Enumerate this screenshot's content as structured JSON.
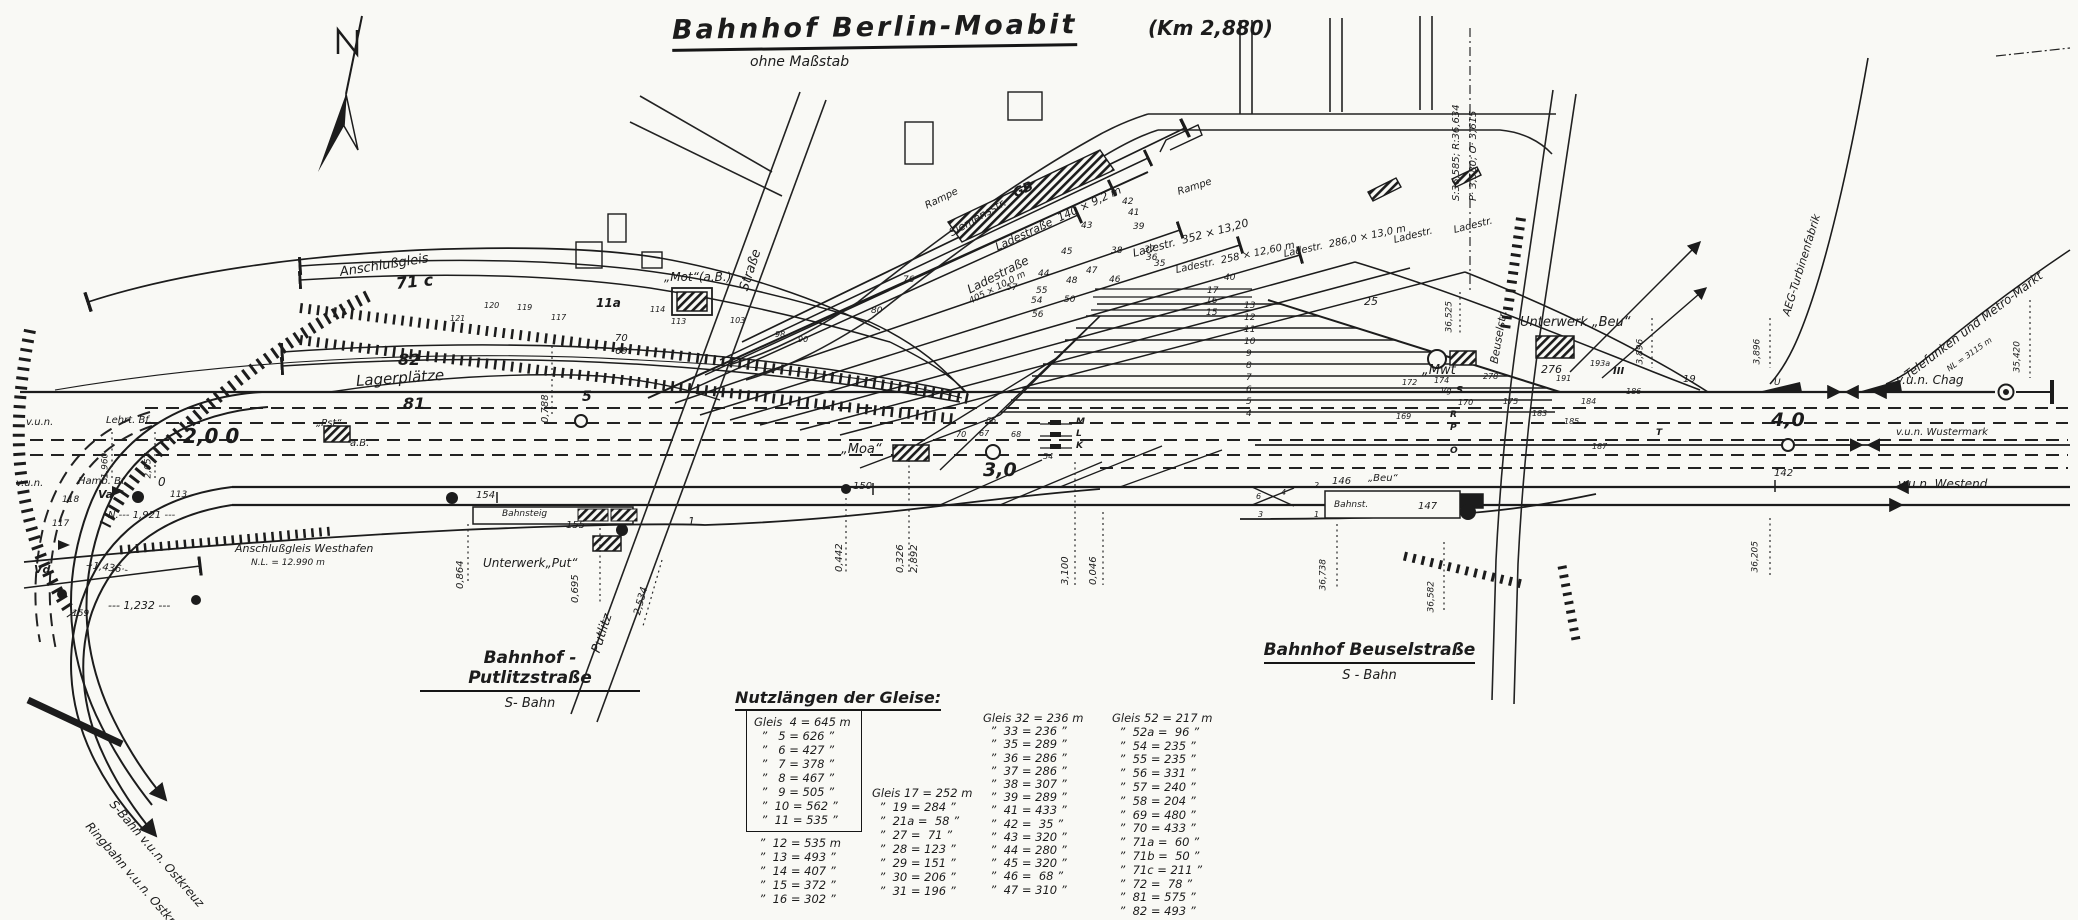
{
  "title": {
    "main": "Bahnhof Berlin-Moabit",
    "km": "(Km 2,880)",
    "subtitle": "ohne Maßstab"
  },
  "stations": [
    {
      "name": "Bahnhof - Putlitzstraße",
      "type": "S- Bahn"
    },
    {
      "name": "Bahnhof Beuselstraße",
      "type": "S - Bahn"
    }
  ],
  "track_lengths": {
    "title": "Nutzlängen der Gleise:",
    "col1_boxed": [
      "Gleis  4 = 645 m",
      "  ”   5 = 626 ”",
      "  ”   6 = 427 ”",
      "  ”   7 = 378 ”",
      "  ”   8 = 467 ”",
      "  ”   9 = 505 ”",
      "  ”  10 = 562 ”",
      "  ”  11 = 535 ”"
    ],
    "col1_rest": [
      "  ”  12 = 535 m",
      "  ”  13 = 493 ”",
      "  ”  14 = 407 ”",
      "  ”  15 = 372 ”",
      "  ”  16 = 302 ”"
    ],
    "col2": [
      "Gleis 17 = 252 m",
      "  ”  19 = 284 ”",
      "  ”  21a =  58 ”",
      "  ”  27 =  71 ”",
      "  ”  28 = 123 ”",
      "  ”  29 = 151 ”",
      "  ”  30 = 206 ”",
      "  ”  31 = 196 ”"
    ],
    "col3": [
      "Gleis 32 = 236 m",
      "  ”  33 = 236 ”",
      "  ”  35 = 289 ”",
      "  ”  36 = 286 ”",
      "  ”  37 = 286 ”",
      "  ”  38 = 307 ”",
      "  ”  39 = 289 ”",
      "  ”  41 = 433 ”",
      "  ”  42 =  35 ”",
      "  ”  43 = 320 ”",
      "  ”  44 = 280 ”",
      "  ”  45 = 320 ”",
      "  ”  46 =  68 ”",
      "  ”  47 = 310 ”"
    ],
    "col4": [
      "Gleis 52 = 217 m",
      "  ”  52a =  96 ”",
      "  ”  54 = 235 ”",
      "  ”  55 = 235 ”",
      "  ”  56 = 331 ”",
      "  ”  57 = 240 ”",
      "  ”  58 = 204 ”",
      "  ”  69 = 480 ”",
      "  ”  70 = 433 ”",
      "  ”  71a =  60 ”",
      "  ”  71b =  50 ”",
      "  ”  71c = 211 ”",
      "  ”  72 =  78 ”",
      "  ”  81 = 575 ”",
      "  ”  82 = 493 ”"
    ]
  },
  "annotations": [
    {
      "t": "Anschlußgleis",
      "x": 340,
      "y": 266,
      "r": -9,
      "s": 13,
      "n": "label-anschlussgleis"
    },
    {
      "t": "71 c",
      "x": 396,
      "y": 276,
      "r": -6,
      "s": 16,
      "c": "b"
    },
    {
      "t": "11a",
      "x": 596,
      "y": 297,
      "s": 12,
      "c": "b"
    },
    {
      "t": "70",
      "x": 615,
      "y": 334
    },
    {
      "t": "69",
      "x": 615,
      "y": 347
    },
    {
      "t": "82",
      "x": 398,
      "y": 352,
      "s": 16,
      "c": "b"
    },
    {
      "t": "Lagerplätze",
      "x": 356,
      "y": 374,
      "r": -4,
      "s": 15,
      "n": "label-lagerplaetze"
    },
    {
      "t": "81",
      "x": 403,
      "y": 396,
      "s": 16,
      "c": "b"
    },
    {
      "t": "0,788",
      "x": 546,
      "y": 418,
      "r": -90
    },
    {
      "t": "5",
      "x": 582,
      "y": 390,
      "s": 14,
      "c": "b"
    },
    {
      "t": "2,0 0",
      "x": 183,
      "y": 426,
      "s": 20,
      "c": "b",
      "n": "km-post-2"
    },
    {
      "t": "v.u.n.",
      "x": 26,
      "y": 418
    },
    {
      "t": "Lehrt. Bf.",
      "x": 106,
      "y": 416,
      "n": "label-lehrter-bf"
    },
    {
      "t": "1,960",
      "x": 106,
      "y": 474,
      "r": -90,
      "s": 9
    },
    {
      "t": "2,057",
      "x": 149,
      "y": 474,
      "r": -90,
      "s": 9
    },
    {
      "t": "v.u.n.",
      "x": 16,
      "y": 479
    },
    {
      "t": "Hamb. Bf.",
      "x": 78,
      "y": 477,
      "n": "label-hamburger-bf"
    },
    {
      "t": "0",
      "x": 158,
      "y": 476,
      "s": 12
    },
    {
      "t": "Va",
      "x": 98,
      "y": 489,
      "s": 11,
      "c": "b"
    },
    {
      "t": "118",
      "x": 62,
      "y": 496,
      "s": 9
    },
    {
      "t": "113",
      "x": 170,
      "y": 491,
      "s": 9
    },
    {
      "t": "N.--- 1,921 ---",
      "x": 108,
      "y": 511
    },
    {
      "t": "117",
      "x": 52,
      "y": 520,
      "s": 9
    },
    {
      "t": "Vd",
      "x": 34,
      "y": 564,
      "s": 11,
      "c": "b"
    },
    {
      "t": "-·1,436·-",
      "x": 86,
      "y": 561,
      "r": 7
    },
    {
      "t": "159",
      "x": 72,
      "y": 610,
      "s": 9
    },
    {
      "t": "--- 1,232 ---",
      "x": 108,
      "y": 600,
      "s": 11
    },
    {
      "t": "Anschlußgleis Westhafen",
      "x": 235,
      "y": 543,
      "s": 11,
      "n": "label-anschlussgleis-westhafen"
    },
    {
      "t": "N.L. = 12.990 m",
      "x": 251,
      "y": 559,
      "s": 9
    },
    {
      "t": "S-Bahn v.u.n. Ostkreuz",
      "x": 112,
      "y": 796,
      "r": 49,
      "s": 12,
      "n": "label-sbahn-ostkreuz"
    },
    {
      "t": "Ringbahn v.u.n. Ostkreuz",
      "x": 88,
      "y": 818,
      "r": 49,
      "s": 12,
      "n": "label-ringbahn-ostkreuz"
    },
    {
      "t": "„Pst“",
      "x": 316,
      "y": 419,
      "n": "label-stellwerk-pst"
    },
    {
      "t": "a.B.",
      "x": 350,
      "y": 439
    },
    {
      "t": "„Mot“(a.B.)",
      "x": 664,
      "y": 271,
      "s": 12,
      "n": "label-stellwerk-mot"
    },
    {
      "t": "Straße",
      "x": 744,
      "y": 284,
      "r": -72,
      "s": 13,
      "n": "label-strasse"
    },
    {
      "t": "Siemensstr.",
      "x": 950,
      "y": 228,
      "r": -30,
      "s": 11,
      "n": "label-siemensstrasse"
    },
    {
      "t": "Rampe",
      "x": 926,
      "y": 202,
      "r": -26
    },
    {
      "t": "Rampe",
      "x": 1178,
      "y": 188,
      "r": -18
    },
    {
      "t": "GB",
      "x": 1014,
      "y": 188,
      "r": -25,
      "s": 13,
      "c": "b",
      "n": "label-gueterboden"
    },
    {
      "t": "Ladestraße  140 × 9,2 m",
      "x": 996,
      "y": 242,
      "r": -25,
      "s": 11,
      "n": "label-ladestrasse-140"
    },
    {
      "t": "Ladestraße",
      "x": 968,
      "y": 284,
      "r": -27,
      "s": 12
    },
    {
      "t": "405 × 10,0 m",
      "x": 970,
      "y": 298,
      "r": -27,
      "s": 9
    },
    {
      "t": "Ladestr.  352 × 13,20",
      "x": 1133,
      "y": 248,
      "r": -15,
      "s": 11
    },
    {
      "t": "Ladestr.  258 × 12,60 m",
      "x": 1176,
      "y": 266,
      "r": -12
    },
    {
      "t": "Ladestr.  286,0 × 13,0 m",
      "x": 1284,
      "y": 250,
      "r": -12
    },
    {
      "t": "Ladestr.",
      "x": 1394,
      "y": 236,
      "r": -14
    },
    {
      "t": "Ladestr.",
      "x": 1454,
      "y": 226,
      "r": -14
    },
    {
      "t": "120",
      "x": 484,
      "y": 302,
      "s": 8
    },
    {
      "t": "121",
      "x": 450,
      "y": 315,
      "s": 8
    },
    {
      "t": "119",
      "x": 517,
      "y": 304,
      "s": 8
    },
    {
      "t": "117",
      "x": 551,
      "y": 314,
      "s": 8
    },
    {
      "t": "114",
      "x": 650,
      "y": 306,
      "s": 8
    },
    {
      "t": "113",
      "x": 671,
      "y": 318,
      "s": 8
    },
    {
      "t": "103",
      "x": 730,
      "y": 317,
      "s": 8
    },
    {
      "t": "98",
      "x": 775,
      "y": 331,
      "s": 8
    },
    {
      "t": "90",
      "x": 798,
      "y": 336,
      "s": 8
    },
    {
      "t": "76",
      "x": 903,
      "y": 276,
      "s": 9
    },
    {
      "t": "80",
      "x": 871,
      "y": 307,
      "s": 9
    },
    {
      "t": "25",
      "x": 1364,
      "y": 296,
      "s": 11
    },
    {
      "t": "42",
      "x": 1122,
      "y": 198,
      "s": 9
    },
    {
      "t": "41",
      "x": 1128,
      "y": 209,
      "s": 9
    },
    {
      "t": "39",
      "x": 1133,
      "y": 223,
      "s": 9
    },
    {
      "t": "38",
      "x": 1111,
      "y": 247,
      "s": 9
    },
    {
      "t": "37",
      "x": 1144,
      "y": 246,
      "s": 9
    },
    {
      "t": "36",
      "x": 1146,
      "y": 254,
      "s": 9
    },
    {
      "t": "35",
      "x": 1154,
      "y": 260,
      "s": 9
    },
    {
      "t": "43",
      "x": 1081,
      "y": 222,
      "s": 9
    },
    {
      "t": "45",
      "x": 1061,
      "y": 248,
      "s": 9
    },
    {
      "t": "44",
      "x": 1038,
      "y": 270,
      "s": 9
    },
    {
      "t": "47",
      "x": 1086,
      "y": 267,
      "s": 9
    },
    {
      "t": "46",
      "x": 1109,
      "y": 276,
      "s": 9
    },
    {
      "t": "48",
      "x": 1066,
      "y": 277,
      "s": 9
    },
    {
      "t": "50",
      "x": 1064,
      "y": 296,
      "s": 9
    },
    {
      "t": "55",
      "x": 1036,
      "y": 287,
      "s": 9
    },
    {
      "t": "54",
      "x": 1031,
      "y": 297,
      "s": 9
    },
    {
      "t": "56",
      "x": 1032,
      "y": 311,
      "s": 9
    },
    {
      "t": "57",
      "x": 1006,
      "y": 284,
      "s": 9
    },
    {
      "t": "17",
      "x": 1207,
      "y": 287,
      "s": 9
    },
    {
      "t": "16",
      "x": 1206,
      "y": 297,
      "s": 9
    },
    {
      "t": "15",
      "x": 1206,
      "y": 309,
      "s": 9
    },
    {
      "t": "40",
      "x": 1224,
      "y": 274,
      "s": 9
    },
    {
      "t": "13",
      "x": 1244,
      "y": 302,
      "s": 9
    },
    {
      "t": "12",
      "x": 1244,
      "y": 314,
      "s": 9
    },
    {
      "t": "11",
      "x": 1244,
      "y": 326,
      "s": 9
    },
    {
      "t": "10",
      "x": 1244,
      "y": 338,
      "s": 9
    },
    {
      "t": "9",
      "x": 1246,
      "y": 350,
      "s": 9
    },
    {
      "t": "8",
      "x": 1246,
      "y": 362,
      "s": 9
    },
    {
      "t": "7",
      "x": 1246,
      "y": 374,
      "s": 9
    },
    {
      "t": "6",
      "x": 1246,
      "y": 386,
      "s": 9
    },
    {
      "t": "5",
      "x": 1246,
      "y": 398,
      "s": 9
    },
    {
      "t": "4",
      "x": 1246,
      "y": 410,
      "s": 9
    },
    {
      "t": "„Moa“",
      "x": 841,
      "y": 443,
      "s": 13,
      "n": "label-stellwerk-moa"
    },
    {
      "t": "3,0",
      "x": 983,
      "y": 461,
      "s": 19,
      "c": "b",
      "n": "km-post-3"
    },
    {
      "t": "150",
      "x": 853,
      "y": 482
    },
    {
      "t": "0,442",
      "x": 840,
      "y": 567,
      "r": -90
    },
    {
      "t": "0,326",
      "x": 901,
      "y": 568,
      "r": -90
    },
    {
      "t": "2,892",
      "x": 915,
      "y": 568,
      "r": -90
    },
    {
      "t": "3,100",
      "x": 1066,
      "y": 580,
      "r": -90
    },
    {
      "t": "0,046",
      "x": 1094,
      "y": 580,
      "r": -90
    },
    {
      "t": "M",
      "x": 1076,
      "y": 418,
      "s": 9,
      "c": "b"
    },
    {
      "t": "L",
      "x": 1076,
      "y": 430,
      "s": 9,
      "c": "b"
    },
    {
      "t": "K",
      "x": 1076,
      "y": 442,
      "s": 9,
      "c": "b"
    },
    {
      "t": "66",
      "x": 986,
      "y": 417,
      "s": 8
    },
    {
      "t": "67",
      "x": 979,
      "y": 430,
      "s": 8
    },
    {
      "t": "70",
      "x": 956,
      "y": 431,
      "s": 8
    },
    {
      "t": "68",
      "x": 1011,
      "y": 431,
      "s": 8
    },
    {
      "t": "54",
      "x": 1043,
      "y": 453,
      "s": 8
    },
    {
      "t": "154",
      "x": 476,
      "y": 491
    },
    {
      "t": "Bahnsteig",
      "x": 502,
      "y": 510,
      "s": 9,
      "n": "label-bahnsteig-putlitz"
    },
    {
      "t": "155",
      "x": 566,
      "y": 521
    },
    {
      "t": "Unterwerk„Put“",
      "x": 483,
      "y": 557,
      "s": 12,
      "n": "label-unterwerk-put"
    },
    {
      "t": "0,864",
      "x": 461,
      "y": 584,
      "r": -90
    },
    {
      "t": "0,695",
      "x": 576,
      "y": 598,
      "r": -90
    },
    {
      "t": "Putlitz",
      "x": 596,
      "y": 646,
      "r": -72,
      "s": 13,
      "n": "label-putlitz-strasse"
    },
    {
      "t": "2,534",
      "x": 638,
      "y": 610,
      "r": -75
    },
    {
      "t": "1",
      "x": 688,
      "y": 516,
      "s": 11
    },
    {
      "t": "Unterwerk „Beu“",
      "x": 1520,
      "y": 316,
      "s": 13,
      "n": "label-unterwerk-beu"
    },
    {
      "t": "Beuselstr.",
      "x": 1494,
      "y": 358,
      "r": -80,
      "s": 11,
      "n": "label-beusselstrasse"
    },
    {
      "t": "„Mwt",
      "x": 1422,
      "y": 364,
      "s": 13,
      "n": "label-stellwerk-mwt"
    },
    {
      "t": "36,525",
      "x": 1450,
      "y": 328,
      "r": -90,
      "s": 9
    },
    {
      "t": "S:36,585; R:36,634",
      "x": 1457,
      "y": 196,
      "r": -90
    },
    {
      "t": "P· 3,580; O· 3,615",
      "x": 1474,
      "y": 196,
      "r": -90
    },
    {
      "t": "3,896",
      "x": 1641,
      "y": 360,
      "r": -90,
      "s": 9
    },
    {
      "t": "3,896",
      "x": 1758,
      "y": 360,
      "r": -90,
      "s": 9
    },
    {
      "t": "35,420",
      "x": 2018,
      "y": 368,
      "r": -90,
      "s": 9
    },
    {
      "t": "276",
      "x": 1541,
      "y": 364,
      "s": 11
    },
    {
      "t": "278",
      "x": 1483,
      "y": 373,
      "s": 8
    },
    {
      "t": "191",
      "x": 1556,
      "y": 375,
      "s": 8
    },
    {
      "t": "193a",
      "x": 1590,
      "y": 360,
      "s": 8
    },
    {
      "t": "III",
      "x": 1613,
      "y": 367,
      "c": "b"
    },
    {
      "t": "174",
      "x": 1434,
      "y": 377,
      "s": 8
    },
    {
      "t": "172",
      "x": 1402,
      "y": 379,
      "s": 8
    },
    {
      "t": "170",
      "x": 1458,
      "y": 399,
      "s": 8
    },
    {
      "t": "169",
      "x": 1396,
      "y": 413,
      "s": 8
    },
    {
      "t": "175",
      "x": 1503,
      "y": 398,
      "s": 8
    },
    {
      "t": "183",
      "x": 1532,
      "y": 410,
      "s": 8
    },
    {
      "t": "184",
      "x": 1581,
      "y": 398,
      "s": 8
    },
    {
      "t": "185",
      "x": 1564,
      "y": 418,
      "s": 8
    },
    {
      "t": "186",
      "x": 1626,
      "y": 388,
      "s": 8
    },
    {
      "t": "187",
      "x": 1592,
      "y": 443,
      "s": 8
    },
    {
      "t": "Vg",
      "x": 1441,
      "y": 387,
      "s": 8
    },
    {
      "t": "S",
      "x": 1456,
      "y": 386,
      "c": "b"
    },
    {
      "t": "R",
      "x": 1450,
      "y": 411,
      "s": 9,
      "c": "b"
    },
    {
      "t": "P",
      "x": 1450,
      "y": 424,
      "s": 9,
      "c": "b"
    },
    {
      "t": "O",
      "x": 1450,
      "y": 447,
      "s": 9,
      "c": "b"
    },
    {
      "t": "T",
      "x": 1656,
      "y": 429,
      "s": 9,
      "c": "b"
    },
    {
      "t": "19",
      "x": 1683,
      "y": 375
    },
    {
      "t": "2",
      "x": 1314,
      "y": 482,
      "s": 8
    },
    {
      "t": "146",
      "x": 1332,
      "y": 477
    },
    {
      "t": "„Beu“",
      "x": 1368,
      "y": 474,
      "n": "label-stellwerk-beu"
    },
    {
      "t": "Bahnst.",
      "x": 1334,
      "y": 501,
      "s": 9,
      "n": "label-bahnsteig-beussel"
    },
    {
      "t": "147",
      "x": 1418,
      "y": 502
    },
    {
      "t": "36,738",
      "x": 1324,
      "y": 586,
      "r": -90,
      "s": 9
    },
    {
      "t": "36,582",
      "x": 1432,
      "y": 608,
      "r": -90,
      "s": 9
    },
    {
      "t": "6",
      "x": 1256,
      "y": 493,
      "s": 8
    },
    {
      "t": "4",
      "x": 1281,
      "y": 489,
      "s": 8
    },
    {
      "t": "3",
      "x": 1258,
      "y": 511,
      "s": 8
    },
    {
      "t": "1",
      "x": 1314,
      "y": 511,
      "s": 8
    },
    {
      "t": "U",
      "x": 1774,
      "y": 379,
      "s": 9
    },
    {
      "t": "v.u.n. Chag",
      "x": 1896,
      "y": 374,
      "s": 12,
      "n": "label-vun-chag"
    },
    {
      "t": "v.u.n. Wustermark",
      "x": 1896,
      "y": 428,
      "n": "label-vun-wustermark"
    },
    {
      "t": "v.u.n. Westend",
      "x": 1898,
      "y": 478,
      "s": 12,
      "n": "label-vun-westend"
    },
    {
      "t": "4,0",
      "x": 1771,
      "y": 411,
      "s": 19,
      "c": "b",
      "n": "km-post-4"
    },
    {
      "t": "142",
      "x": 1774,
      "y": 469
    },
    {
      "t": "36,205",
      "x": 1756,
      "y": 568,
      "r": -90,
      "s": 9
    },
    {
      "t": "Telefunken und Metro-Markt",
      "x": 1906,
      "y": 370,
      "r": -37,
      "s": 12,
      "n": "label-telefunken-metro-markt"
    },
    {
      "t": "NL = 3115 m",
      "x": 1948,
      "y": 366,
      "r": -35,
      "s": 8
    },
    {
      "t": "AEG-Turbinenfabrik",
      "x": 1786,
      "y": 310,
      "r": -73,
      "s": 11,
      "n": "label-aeg-turbinenfabrik"
    }
  ]
}
